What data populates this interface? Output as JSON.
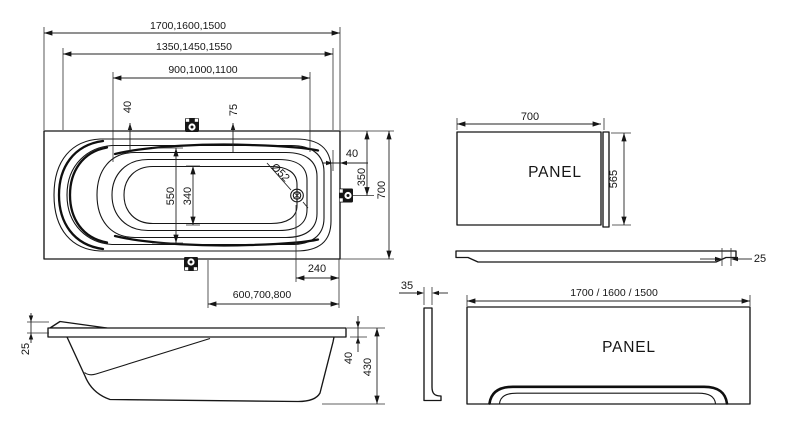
{
  "colors": {
    "background": "#ffffff",
    "line": "#161616"
  },
  "views": {
    "tub_top": {
      "dims": {
        "overall_length": "1700,1600,1500",
        "rim_length": "1350,1450,1550",
        "basin_length": "900,1000,1100",
        "edge_offset": "40",
        "grip_offset": "75",
        "inner_width": "550",
        "floor_width": "340",
        "drain_diameter": "Ø52",
        "side_offset": "40",
        "drain_from_edge": "350",
        "overall_width": "700",
        "drain_from_end": "240",
        "floor_from_end": "600,700,800"
      }
    },
    "tub_side": {
      "dims": {
        "rim_thickness": "25",
        "rim_drop": "40",
        "overall_height": "430"
      }
    },
    "side_panel": {
      "label": "PANEL",
      "dims": {
        "width": "700",
        "height": "565"
      }
    },
    "panel_plan": {
      "dims": {
        "edge_thickness": "25"
      }
    },
    "front_panel": {
      "label": "PANEL",
      "dims": {
        "profile_thickness": "35",
        "lengths": "1700 / 1600 / 1500"
      }
    }
  }
}
